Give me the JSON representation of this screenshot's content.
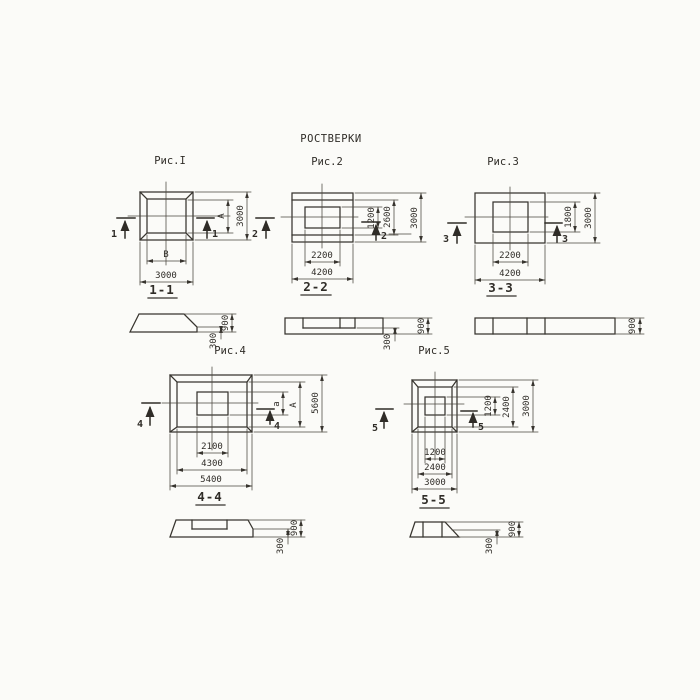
{
  "title": "РОСТВЕРКИ",
  "fig1": {
    "caption": "Рис.I",
    "cut": "1",
    "section": "1-1",
    "right": [
      "А",
      "3000"
    ],
    "bottom": [
      "В",
      "3000"
    ]
  },
  "fig2": {
    "caption": "Рис.2",
    "cut": "2",
    "section": "2-2",
    "right": [
      "1200",
      "2600",
      "3000"
    ],
    "bottom": [
      "2200",
      "4200"
    ]
  },
  "fig3": {
    "caption": "Рис.3",
    "cut": "3",
    "section": "3-3",
    "right": [
      "1800",
      "3000"
    ],
    "bottom": [
      "2200",
      "4200"
    ]
  },
  "fig4": {
    "caption": "Рис.4",
    "cut": "4",
    "section": "4-4",
    "right": [
      "а",
      "А",
      "5600"
    ],
    "bottom": [
      "2100",
      "4300",
      "5400"
    ]
  },
  "fig5": {
    "caption": "Рис.5",
    "cut": "5",
    "section": "5-5",
    "right": [
      "1200",
      "2400",
      "3000"
    ],
    "bottom": [
      "1200",
      "2400",
      "3000"
    ]
  },
  "sec1": {
    "dims": [
      "300",
      "900"
    ]
  },
  "sec2": {
    "dims": [
      "300",
      "900"
    ]
  },
  "sec3": {
    "dims": [
      "900"
    ]
  },
  "sec4": {
    "dims": [
      "300",
      "900"
    ]
  },
  "sec5": {
    "dims": [
      "300",
      "900"
    ]
  },
  "colors": {
    "ink": "#37342e",
    "paper": "#fbfbf8"
  }
}
